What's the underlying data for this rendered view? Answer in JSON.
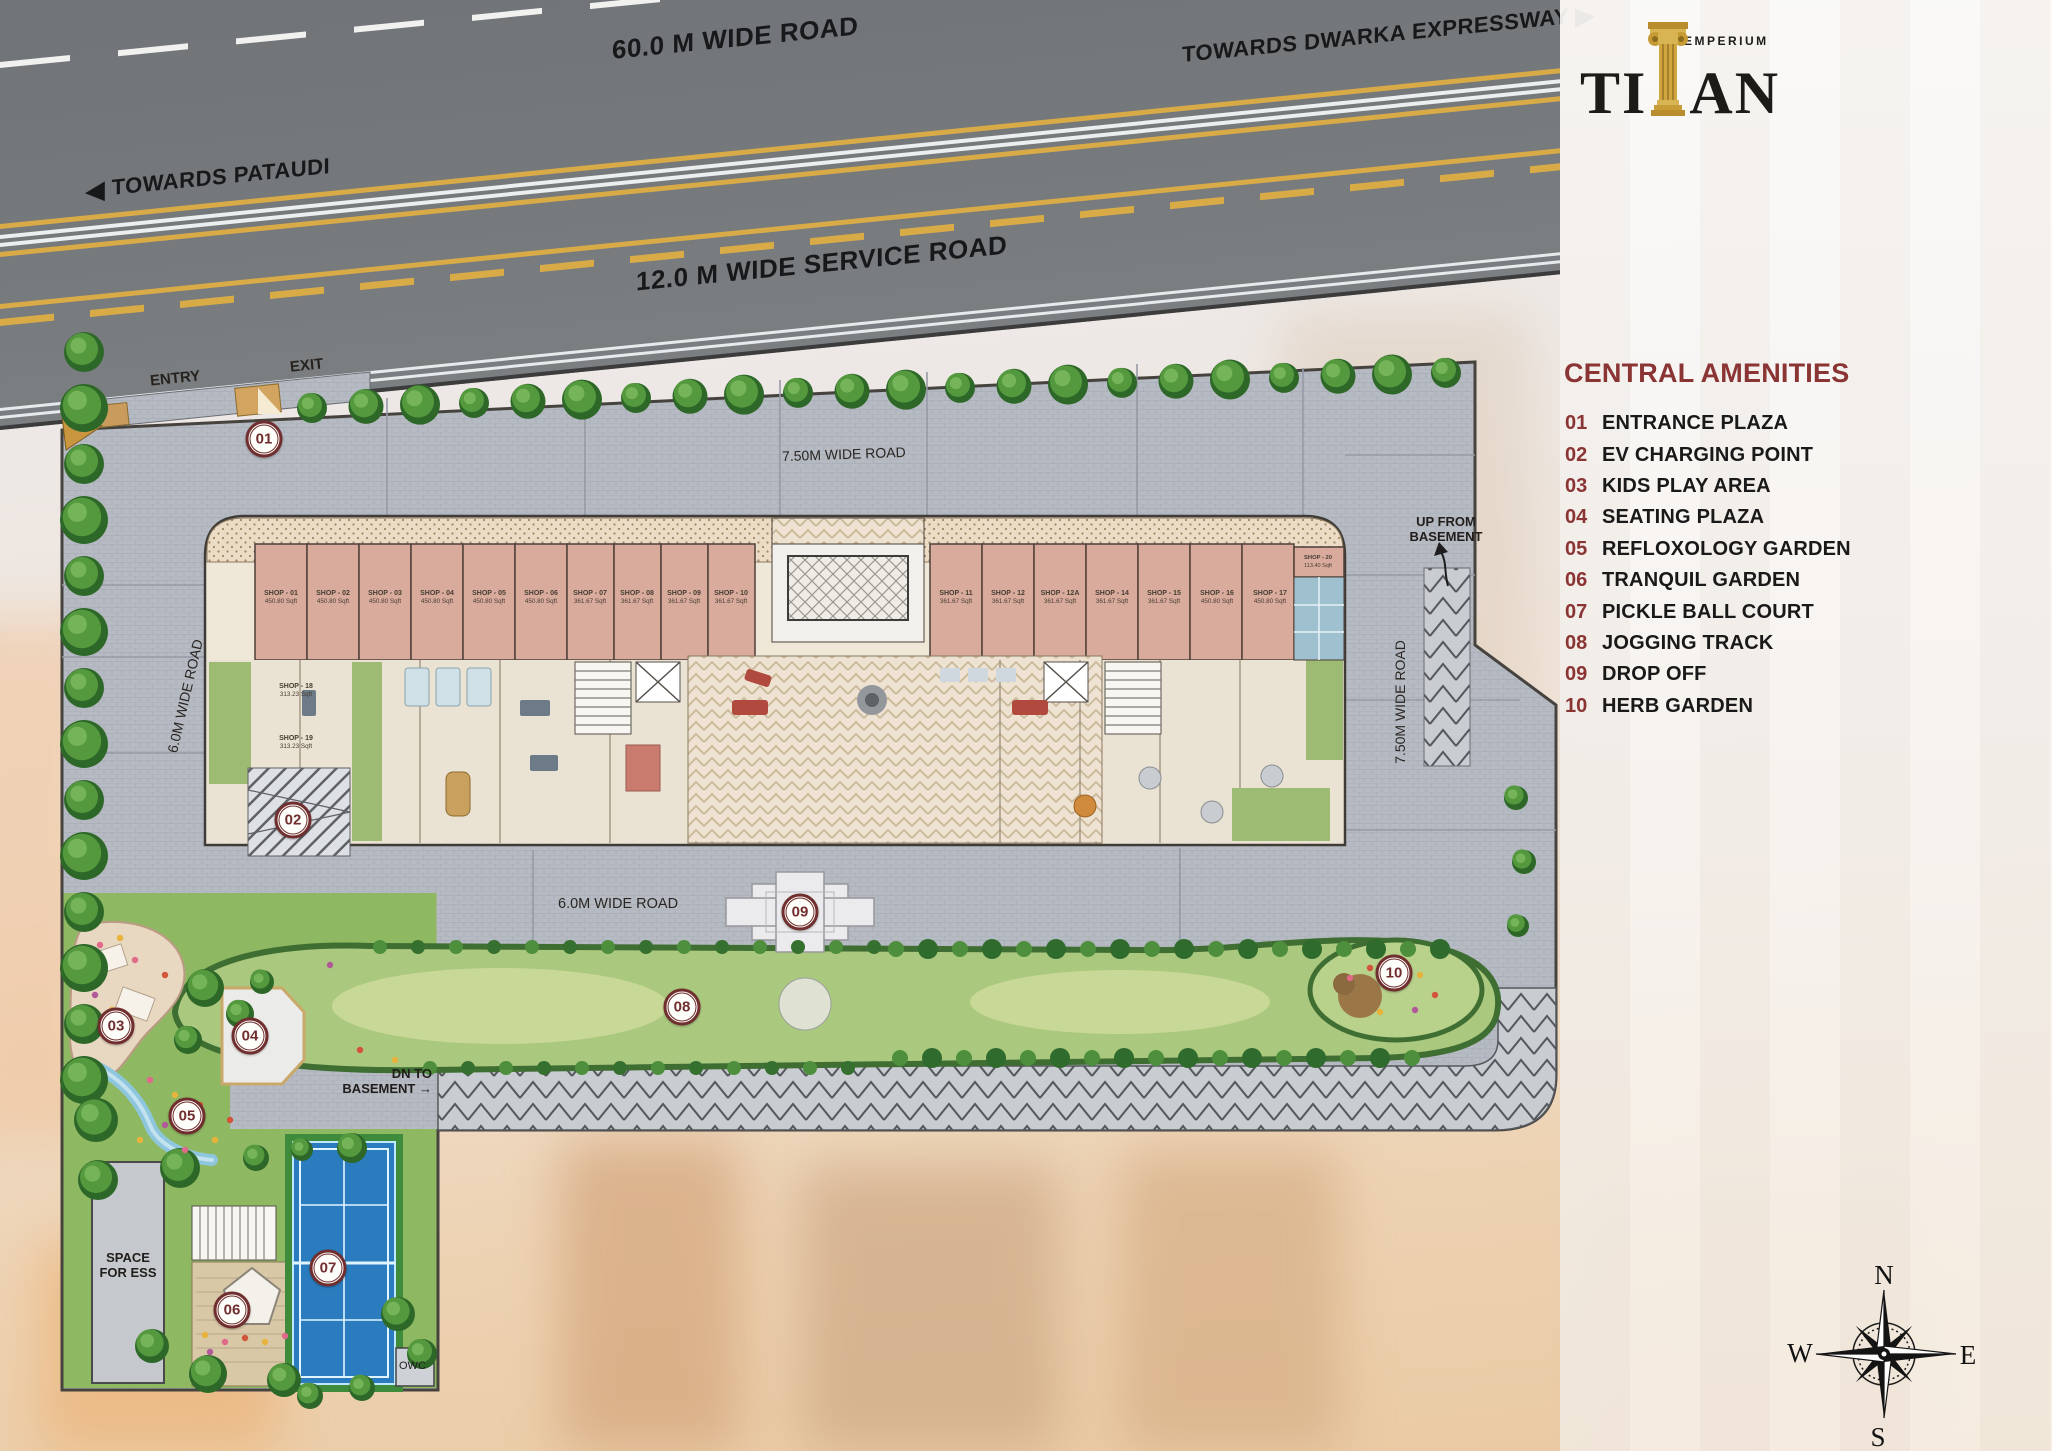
{
  "brand": {
    "name": "TITAN",
    "name_left": "TI",
    "name_right": "AN",
    "tagline": "EMPERIUM"
  },
  "panel": {
    "heading": "CENTRAL AMENITIES",
    "heading_color": "#8a3434",
    "amenities": [
      {
        "num": "01",
        "label": "ENTRANCE PLAZA"
      },
      {
        "num": "02",
        "label": "EV CHARGING POINT"
      },
      {
        "num": "03",
        "label": "KIDS PLAY AREA"
      },
      {
        "num": "04",
        "label": "SEATING PLAZA"
      },
      {
        "num": "05",
        "label": "REFLOXOLOGY GARDEN"
      },
      {
        "num": "06",
        "label": "TRANQUIL GARDEN"
      },
      {
        "num": "07",
        "label": "PICKLE BALL COURT"
      },
      {
        "num": "08",
        "label": "JOGGING TRACK"
      },
      {
        "num": "09",
        "label": "DROP OFF"
      },
      {
        "num": "10",
        "label": "HERB GARDEN"
      }
    ]
  },
  "roads": {
    "main": "60.0 M WIDE ROAD",
    "service": "12.0 M WIDE SERVICE ROAD",
    "towards_left": "TOWARDS PATAUDI",
    "towards_right": "TOWARDS DWARKA EXPRESSWAY",
    "arrow_left": "◀",
    "arrow_right": "▶",
    "internal_top": "7.50M WIDE ROAD",
    "internal_right": "7.50M WIDE ROAD",
    "internal_left": "6.0M WIDE ROAD",
    "internal_bottom": "6.0M WIDE ROAD"
  },
  "site": {
    "entry": "ENTRY",
    "exit": "EXIT",
    "up_basement_l1": "UP FROM",
    "up_basement_l2": "BASEMENT",
    "dn_basement_l1": "DN TO",
    "dn_basement_l2": "BASEMENT",
    "dn_arrow": "→",
    "ess_l1": "SPACE",
    "ess_l2": "FOR ESS",
    "owc": "OWC"
  },
  "shops": [
    {
      "name": "SHOP - 01",
      "area": "450.80 Sqft"
    },
    {
      "name": "SHOP - 02",
      "area": "450.80 Sqft"
    },
    {
      "name": "SHOP - 03",
      "area": "450.80 Sqft"
    },
    {
      "name": "SHOP - 04",
      "area": "450.80 Sqft"
    },
    {
      "name": "SHOP - 05",
      "area": "450.80 Sqft"
    },
    {
      "name": "SHOP - 06",
      "area": "450.80 Sqft"
    },
    {
      "name": "SHOP - 07",
      "area": "361.67 Sqft"
    },
    {
      "name": "SHOP - 08",
      "area": "361.67 Sqft"
    },
    {
      "name": "SHOP - 09",
      "area": "361.67 Sqft"
    },
    {
      "name": "SHOP - 10",
      "area": "361.67 Sqft"
    },
    {
      "name": "SHOP - 11",
      "area": "361.67 Sqft"
    },
    {
      "name": "SHOP - 12",
      "area": "361.67 Sqft"
    },
    {
      "name": "SHOP - 12A",
      "area": "361.67 Sqft"
    },
    {
      "name": "SHOP - 14",
      "area": "361.67 Sqft"
    },
    {
      "name": "SHOP - 15",
      "area": "361.67 Sqft"
    },
    {
      "name": "SHOP - 16",
      "area": "450.80 Sqft"
    },
    {
      "name": "SHOP - 17",
      "area": "450.80 Sqft"
    },
    {
      "name": "SHOP - 18",
      "area": "313.23 Sqft"
    },
    {
      "name": "SHOP - 19",
      "area": "313.23 Sqft"
    },
    {
      "name": "SHOP - 20",
      "area": "113.40 Sqft"
    }
  ],
  "compass": {
    "n": "N",
    "e": "E",
    "s": "S",
    "w": "W"
  },
  "colors": {
    "accent_maroon": "#8a3434",
    "marker_ring": "#702e2e",
    "gold": "#c99b3a",
    "court_blue": "#2b7cbe",
    "shop_fill": "#d9ab9c",
    "lawn": "#a9c87d",
    "paving": "#b6bac2",
    "road_gray": "#75797c"
  }
}
